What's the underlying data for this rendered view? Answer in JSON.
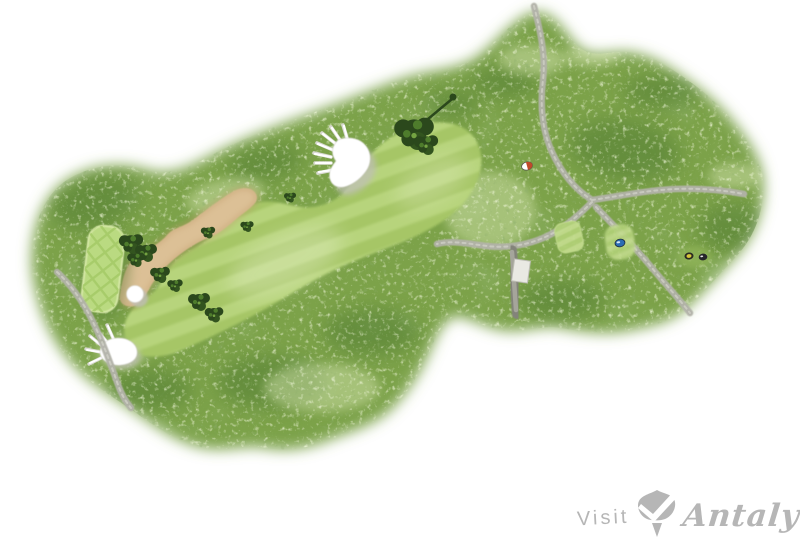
{
  "page": {
    "background_color": "#ffffff"
  },
  "logo": {
    "visit_text": "Visit",
    "brand_text": "Antalya",
    "icon": "tulip-logo-icon",
    "color": "#b6b6b6"
  },
  "map": {
    "kind": "golf-hole-aerial-illustration",
    "palette": {
      "rough_green": "#7ba24a",
      "rough_dark_patch": "#4f7a33",
      "rough_light_speckle": "#d9e8b4",
      "fairway_stripe_light": "#b7d47c",
      "fairway_stripe_dark": "#a6c666",
      "putting_green_base": "#bada81",
      "putting_green_stripe": "#a4ca66",
      "sand": "#dcc096",
      "sand_shadow": "#c19e6d",
      "bunker_white": "#ffffff",
      "bunker_shadow": "#bfbfb6",
      "cart_path": "#b2b2a9",
      "bridge_deck": "#e9e9e3",
      "tree_dark": "#2b481c",
      "tree_highlight": "#4e7c2c"
    },
    "features": {
      "putting_green": "putting-green",
      "waste_bunker": "sand-waste-bunker",
      "fairway": "fairway",
      "white_bunkers": [
        "fairway-bunker",
        "round-greenside-bunker",
        "left-rough-bunker"
      ],
      "cart_paths": "cart-path-network",
      "bridge": "cart-path-bridge",
      "trees": "tree-clusters"
    },
    "tee_markers": [
      {
        "name": "tee-marker-red-white",
        "color": "#c04a2a",
        "accent": "#ffffff"
      },
      {
        "name": "tee-marker-blue",
        "color": "#2b6cb3",
        "accent": "#d6e6f4"
      },
      {
        "name": "tee-marker-yellow",
        "color": "#d8c63c",
        "accent": "#2a2a22"
      },
      {
        "name": "tee-marker-black",
        "color": "#26262a",
        "accent": "#e8e8ea"
      }
    ]
  }
}
